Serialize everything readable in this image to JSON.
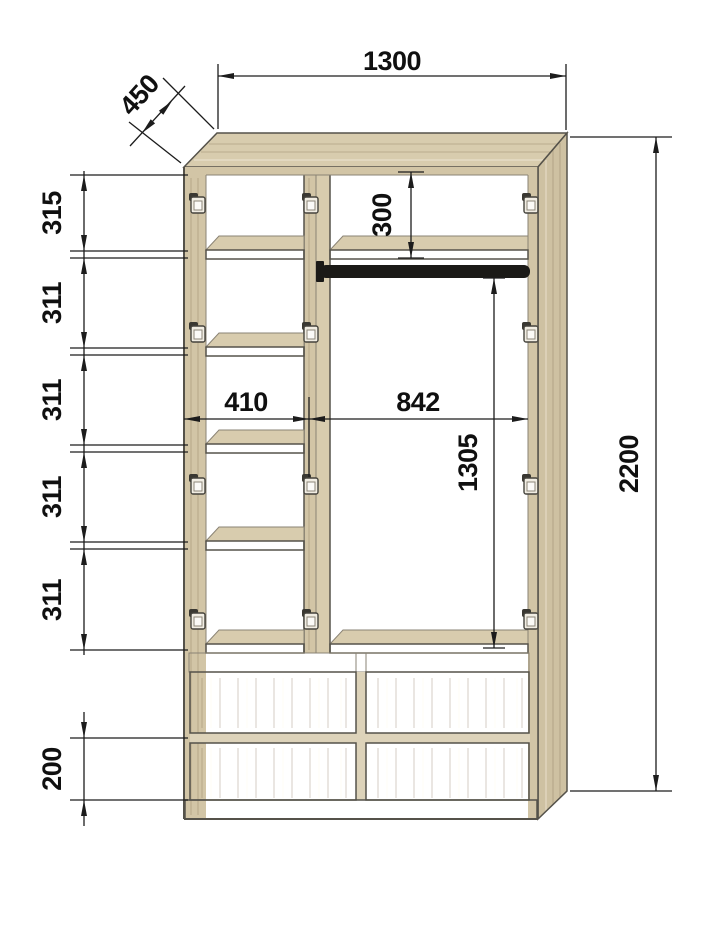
{
  "drawing": {
    "title": "Wardrobe front elevation with dimensions",
    "units": "mm"
  },
  "dims": {
    "width": "1300",
    "depth": "450",
    "height": "2200",
    "top_section": "300",
    "shelf_gap_1": "315",
    "shelf_gap_2": "311",
    "shelf_gap_3": "311",
    "shelf_gap_4": "311",
    "shelf_gap_5": "311",
    "left_section_width": "410",
    "right_section_width": "842",
    "hanging_space_height": "1305",
    "drawer_height": "200"
  },
  "colors": {
    "bg": "#ffffff",
    "wood-top": "#d8ccae",
    "wood-face": "#d2c5a6",
    "wood-rail": "#ddd3ba",
    "wood-side": "#cec1a2",
    "wood-drawer": "#d1c4a5",
    "outline": "#55524a",
    "outline-soft": "#8a8374",
    "rod": "#1b1a17",
    "dim": "#1c1c1c"
  }
}
